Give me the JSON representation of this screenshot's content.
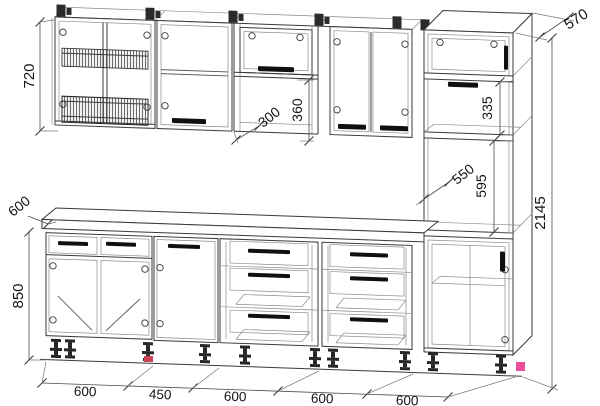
{
  "dims": {
    "wall_cabinet_height": "720",
    "counter_depth": "600",
    "base_height": "850",
    "wall_cabinet_depth": "300",
    "wall_niche_height": "360",
    "tall_top_section_height": "335",
    "tall_niche_depth": "550",
    "tall_niche_height": "595",
    "tall_cabinet_depth": "570",
    "total_height": "2145",
    "bottom_widths": [
      "600",
      "450",
      "600",
      "600",
      "600"
    ]
  },
  "colors": {
    "line": "#3a3a3a",
    "dimension_line": "#4a4a4a",
    "accent_pink": "#ee4f9b",
    "accent_red": "#cc4455",
    "handle": "#101010"
  }
}
